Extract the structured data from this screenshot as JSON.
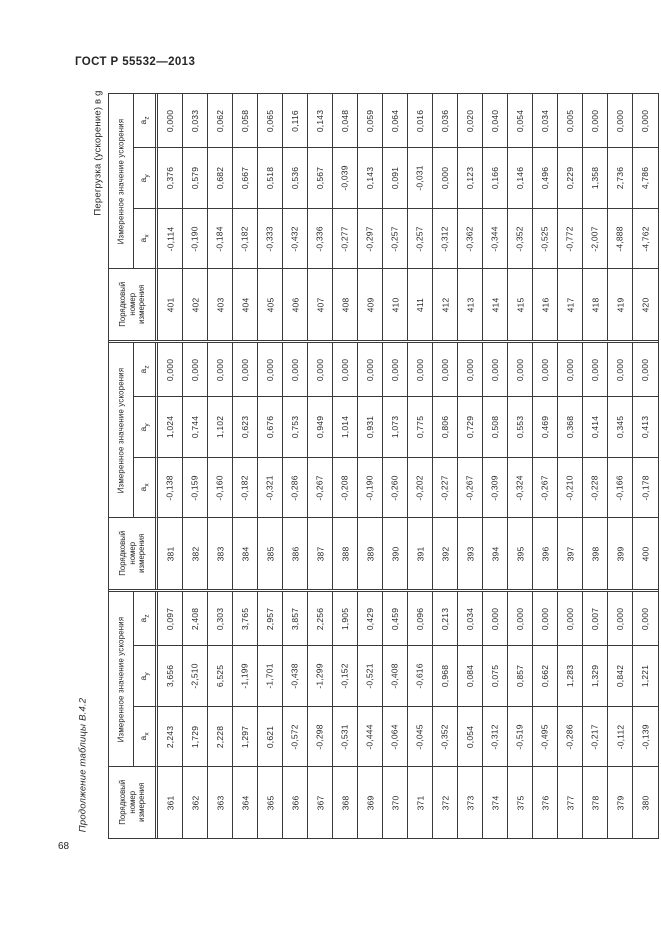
{
  "page": {
    "header_title": "ГОСТ Р 55532—2013",
    "rotated_caption": "Перегрузка (ускорение) в g",
    "rotated_continuation_label": "Продолжение таблицы В.4.2",
    "page_number": "68"
  },
  "table": {
    "ordinal_header_lines": [
      "Порядковый",
      "номер",
      "измерения"
    ],
    "measured_group_header": "Измеренное значение ускорения",
    "axis_base": "a",
    "axis_subs": [
      "z",
      "y",
      "x"
    ],
    "bands": [
      {
        "measurements": [
          {
            "num": "401",
            "ax": "-0,114",
            "ay": "0,376",
            "az": "0,000"
          },
          {
            "num": "402",
            "ax": "-0,190",
            "ay": "0,579",
            "az": "0,033"
          },
          {
            "num": "403",
            "ax": "-0,184",
            "ay": "0,682",
            "az": "0,062"
          },
          {
            "num": "404",
            "ax": "-0,182",
            "ay": "0,667",
            "az": "0,058"
          },
          {
            "num": "405",
            "ax": "-0,333",
            "ay": "0,518",
            "az": "0,065"
          },
          {
            "num": "406",
            "ax": "-0,432",
            "ay": "0,536",
            "az": "0,116"
          },
          {
            "num": "407",
            "ax": "-0,336",
            "ay": "0,567",
            "az": "0,143"
          },
          {
            "num": "408",
            "ax": "-0,277",
            "ay": "-0,039",
            "az": "0,048"
          },
          {
            "num": "409",
            "ax": "-0,297",
            "ay": "0,143",
            "az": "0,059"
          },
          {
            "num": "410",
            "ax": "-0,257",
            "ay": "0,091",
            "az": "0,064"
          },
          {
            "num": "411",
            "ax": "-0,257",
            "ay": "-0,031",
            "az": "0,016"
          },
          {
            "num": "412",
            "ax": "-0,312",
            "ay": "0,000",
            "az": "0,036"
          },
          {
            "num": "413",
            "ax": "-0,362",
            "ay": "0,123",
            "az": "0,020"
          },
          {
            "num": "414",
            "ax": "-0,344",
            "ay": "0,166",
            "az": "0,040"
          },
          {
            "num": "415",
            "ax": "-0,352",
            "ay": "0,146",
            "az": "0,054"
          },
          {
            "num": "416",
            "ax": "-0,525",
            "ay": "0,496",
            "az": "0,034"
          },
          {
            "num": "417",
            "ax": "-0,772",
            "ay": "0,229",
            "az": "0,005"
          },
          {
            "num": "418",
            "ax": "-2,007",
            "ay": "1,358",
            "az": "0,000"
          },
          {
            "num": "419",
            "ax": "-4,888",
            "ay": "2,736",
            "az": "0,000"
          },
          {
            "num": "420",
            "ax": "-4,762",
            "ay": "4,786",
            "az": "0,000"
          }
        ]
      },
      {
        "measurements": [
          {
            "num": "381",
            "ax": "-0,138",
            "ay": "1,024",
            "az": "0,000"
          },
          {
            "num": "382",
            "ax": "-0,159",
            "ay": "0,744",
            "az": "0,000"
          },
          {
            "num": "383",
            "ax": "-0,160",
            "ay": "1,102",
            "az": "0,000"
          },
          {
            "num": "384",
            "ax": "-0,182",
            "ay": "0,623",
            "az": "0,000"
          },
          {
            "num": "385",
            "ax": "-0,321",
            "ay": "0,676",
            "az": "0,000"
          },
          {
            "num": "386",
            "ax": "-0,286",
            "ay": "0,753",
            "az": "0,000"
          },
          {
            "num": "387",
            "ax": "-0,267",
            "ay": "0,949",
            "az": "0,000"
          },
          {
            "num": "388",
            "ax": "-0,208",
            "ay": "1,014",
            "az": "0,000"
          },
          {
            "num": "389",
            "ax": "-0,190",
            "ay": "0,931",
            "az": "0,000"
          },
          {
            "num": "390",
            "ax": "-0,260",
            "ay": "1,073",
            "az": "0,000"
          },
          {
            "num": "391",
            "ax": "-0,202",
            "ay": "0,775",
            "az": "0,000"
          },
          {
            "num": "392",
            "ax": "-0,227",
            "ay": "0,806",
            "az": "0,000"
          },
          {
            "num": "393",
            "ax": "-0,267",
            "ay": "0,729",
            "az": "0,000"
          },
          {
            "num": "394",
            "ax": "-0,309",
            "ay": "0,508",
            "az": "0,000"
          },
          {
            "num": "395",
            "ax": "-0,324",
            "ay": "0,553",
            "az": "0,000"
          },
          {
            "num": "396",
            "ax": "-0,267",
            "ay": "0,469",
            "az": "0,000"
          },
          {
            "num": "397",
            "ax": "-0,210",
            "ay": "0,368",
            "az": "0,000"
          },
          {
            "num": "398",
            "ax": "-0,228",
            "ay": "0,414",
            "az": "0,000"
          },
          {
            "num": "399",
            "ax": "-0,166",
            "ay": "0,345",
            "az": "0,000"
          },
          {
            "num": "400",
            "ax": "-0,178",
            "ay": "0,413",
            "az": "0,000"
          }
        ]
      },
      {
        "measurements": [
          {
            "num": "361",
            "ax": "2,243",
            "ay": "3,656",
            "az": "0,097"
          },
          {
            "num": "362",
            "ax": "1,729",
            "ay": "-2,510",
            "az": "2,408"
          },
          {
            "num": "363",
            "ax": "2,228",
            "ay": "6,525",
            "az": "0,303"
          },
          {
            "num": "364",
            "ax": "1,297",
            "ay": "-1,199",
            "az": "3,765"
          },
          {
            "num": "365",
            "ax": "0,621",
            "ay": "-1,701",
            "az": "2,957"
          },
          {
            "num": "366",
            "ax": "-0,572",
            "ay": "-0,438",
            "az": "3,857"
          },
          {
            "num": "367",
            "ax": "-0,298",
            "ay": "-1,299",
            "az": "2,256"
          },
          {
            "num": "368",
            "ax": "-0,531",
            "ay": "-0,152",
            "az": "1,905"
          },
          {
            "num": "369",
            "ax": "-0,444",
            "ay": "-0,521",
            "az": "0,429"
          },
          {
            "num": "370",
            "ax": "-0,064",
            "ay": "-0,408",
            "az": "0,459"
          },
          {
            "num": "371",
            "ax": "-0,045",
            "ay": "-0,616",
            "az": "0,096"
          },
          {
            "num": "372",
            "ax": "-0,352",
            "ay": "0,968",
            "az": "0,213"
          },
          {
            "num": "373",
            "ax": "0,054",
            "ay": "0,084",
            "az": "0,034"
          },
          {
            "num": "374",
            "ax": "-0,312",
            "ay": "0,075",
            "az": "0,000"
          },
          {
            "num": "375",
            "ax": "-0,519",
            "ay": "0,857",
            "az": "0,000"
          },
          {
            "num": "376",
            "ax": "-0,495",
            "ay": "0,662",
            "az": "0,000"
          },
          {
            "num": "377",
            "ax": "-0,286",
            "ay": "1,283",
            "az": "0,000"
          },
          {
            "num": "378",
            "ax": "-0,217",
            "ay": "1,329",
            "az": "0,007"
          },
          {
            "num": "379",
            "ax": "-0,112",
            "ay": "0,842",
            "az": "0,000"
          },
          {
            "num": "380",
            "ax": "-0,139",
            "ay": "1,221",
            "az": "0,000"
          }
        ]
      }
    ]
  }
}
